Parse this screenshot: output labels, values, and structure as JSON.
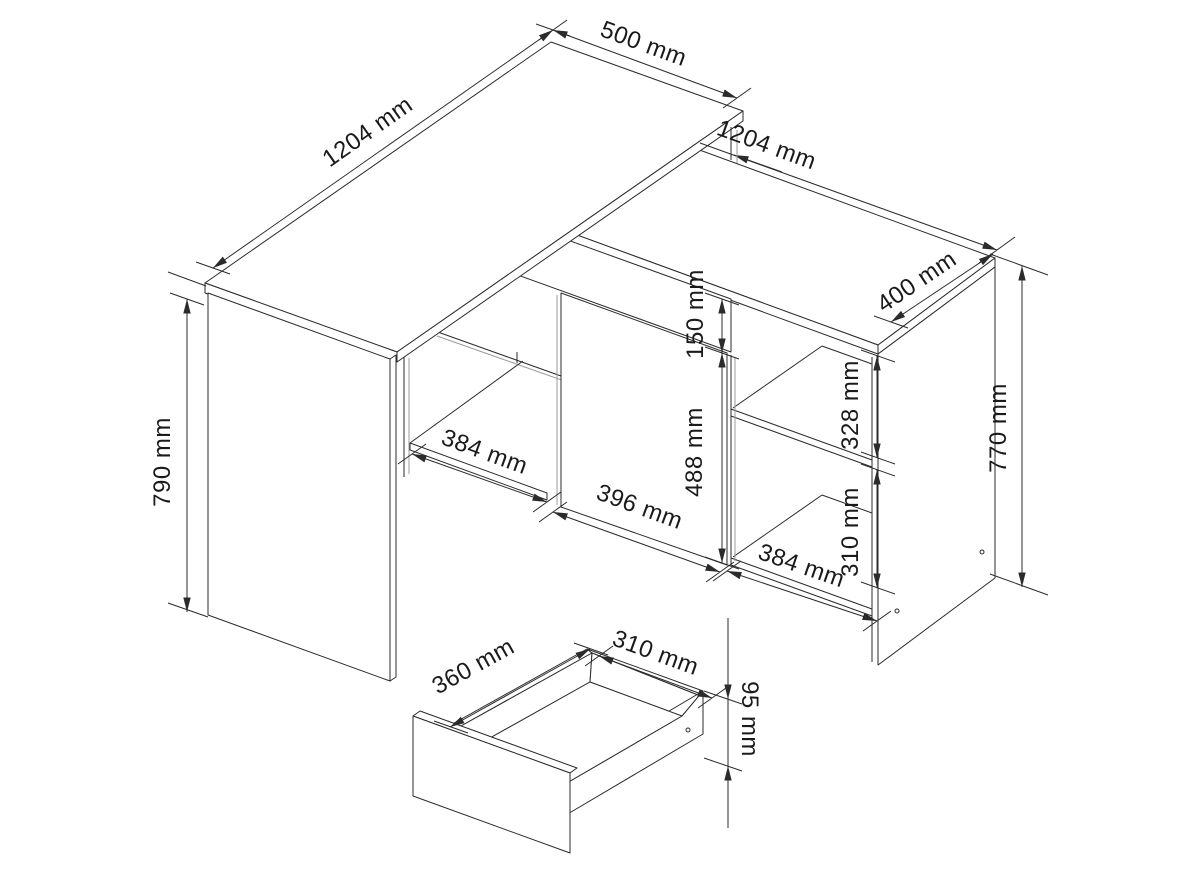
{
  "diagram": {
    "type": "furniture-technical-drawing",
    "subject": "corner desk with sideboard and detached drawer",
    "unit": "mm",
    "colors": {
      "background": "#ffffff",
      "line": "#2b2b2b",
      "gray_line": "#9b9b9b",
      "text": "#1a1a1a"
    }
  },
  "dimensions": [
    {
      "id": "desk-top-length",
      "label": "1204 mm"
    },
    {
      "id": "desk-top-depth",
      "label": "500 mm"
    },
    {
      "id": "sideboard-length",
      "label": "1204 mm"
    },
    {
      "id": "sideboard-depth",
      "label": "400 mm"
    },
    {
      "id": "sideboard-height",
      "label": "770 mm"
    },
    {
      "id": "desk-height",
      "label": "790 mm"
    },
    {
      "id": "top-drawer-front-height",
      "label": "150 mm"
    },
    {
      "id": "door-height",
      "label": "488 mm"
    },
    {
      "id": "right-upper-compartment-height",
      "label": "328 mm"
    },
    {
      "id": "right-lower-compartment-height",
      "label": "310 mm"
    },
    {
      "id": "left-compartment-width",
      "label": "384 mm"
    },
    {
      "id": "door-width",
      "label": "396 mm"
    },
    {
      "id": "right-compartment-width",
      "label": "384 mm"
    },
    {
      "id": "drawer-depth",
      "label": "360 mm"
    },
    {
      "id": "drawer-width",
      "label": "310 mm"
    },
    {
      "id": "drawer-front-height",
      "label": "95 mm"
    }
  ]
}
